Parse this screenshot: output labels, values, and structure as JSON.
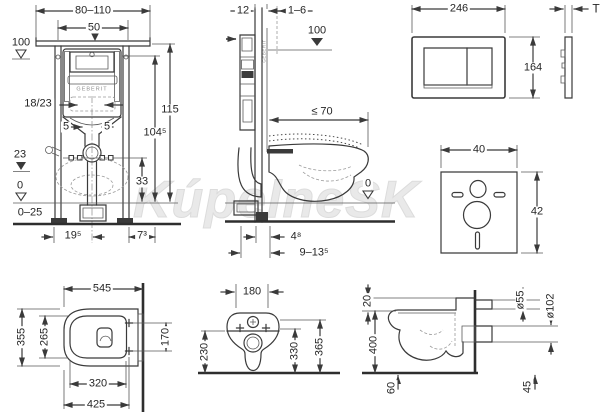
{
  "watermark": "KúpelneSK",
  "brand": "GEBERIT",
  "dims": {
    "frame_front": {
      "width_range": "80–110",
      "rail_spacing": "50",
      "level_100": "100",
      "flush_pipe": "18/23",
      "offset_left": "5",
      "offset_right": "5",
      "height_total": "115",
      "height_upper": "104⁵",
      "level_23": "23",
      "outlet_height": "33",
      "level_0": "0",
      "floor_range": "0–25",
      "foot_depth": "19⁵",
      "front_depth": "7³"
    },
    "frame_side": {
      "rail_depth": "12",
      "wall_lining": "1–6",
      "level_100": "100",
      "bowl_depth": "≤ 70",
      "level_0": "0",
      "outlet_offset": "4⁸",
      "outlet_range": "9–13⁵"
    },
    "flush_plate": {
      "width": "246",
      "height": "164",
      "thickness": "T"
    },
    "insulation_pad": {
      "width": "40",
      "height": "42"
    },
    "wc_top": {
      "length": "545",
      "width": "355",
      "inner_width": "265",
      "bolt_spacing": "170",
      "inner_length": "320",
      "bolt_distance": "425"
    },
    "wc_front": {
      "top_width": "180",
      "rim_height": "230",
      "bottom_height": "330",
      "total_height": "365"
    },
    "wc_side": {
      "top_gap": "20",
      "seat_height": "400",
      "bottom_offset": "60",
      "inlet_dia": "ø55",
      "outlet_dia": "ø102",
      "floor_offset": "45"
    }
  }
}
